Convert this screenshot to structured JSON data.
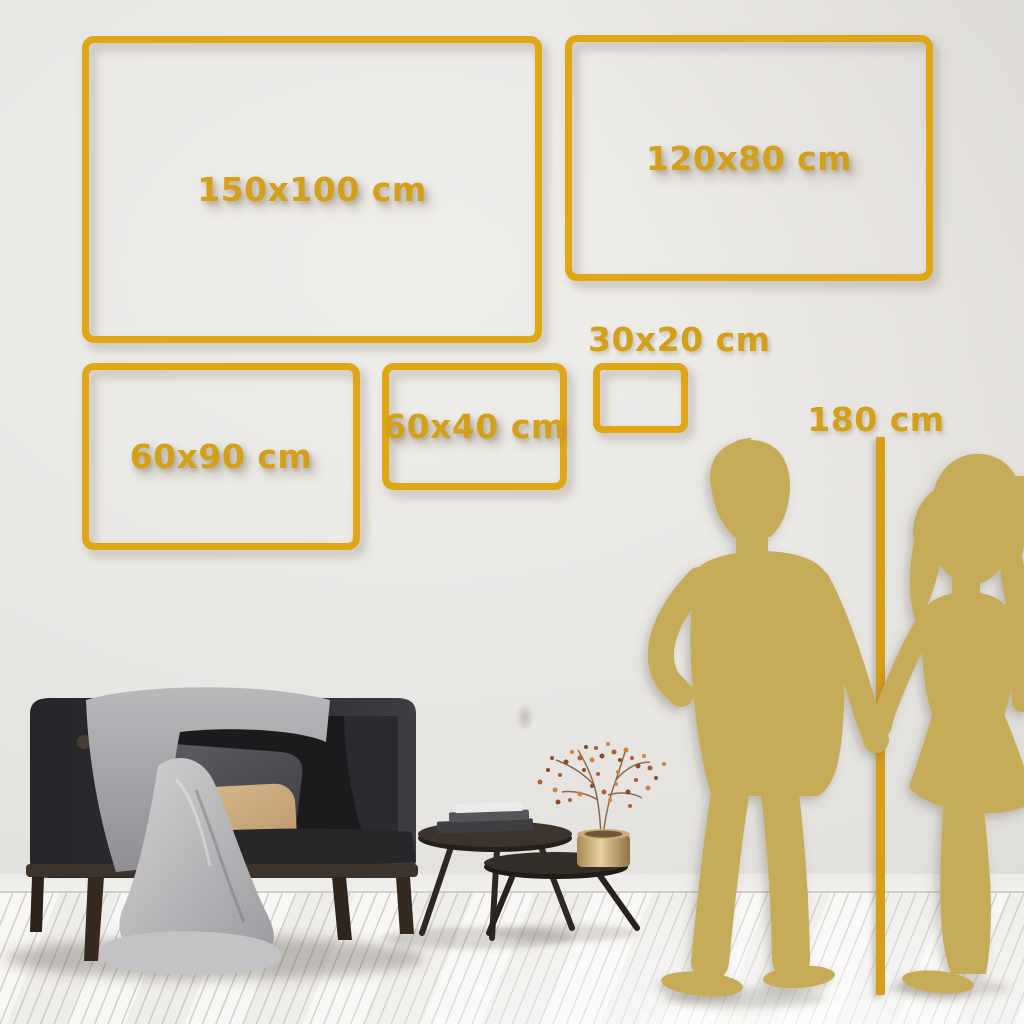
{
  "meta": {
    "type": "wall-art-size-guide-image"
  },
  "palette": {
    "frame_gold": "#DFA713",
    "label_gold": "#D4A019",
    "silhouette_gold": "#C6AC58",
    "line_gold": "#D79E1A",
    "wall": "#E9E7E4",
    "floor": "#F4F3F1"
  },
  "size_options": [
    {
      "id": "150x100",
      "label": "150x100 cm"
    },
    {
      "id": "120x80",
      "label": "120x80 cm"
    },
    {
      "id": "60x90",
      "label": "60x90 cm"
    },
    {
      "id": "60x40",
      "label": "60x40 cm"
    },
    {
      "id": "30x20",
      "label": "30x20 cm"
    }
  ],
  "height_reference": {
    "label": "180 cm"
  },
  "scene_elements": [
    "couple-silhouette",
    "height-reference-line",
    "dark-sofa-with-gray-blanket",
    "gray-pillow",
    "tan-pillow",
    "two-round-coffee-tables",
    "stacked-books",
    "gold-vase-with-dried-branch"
  ]
}
